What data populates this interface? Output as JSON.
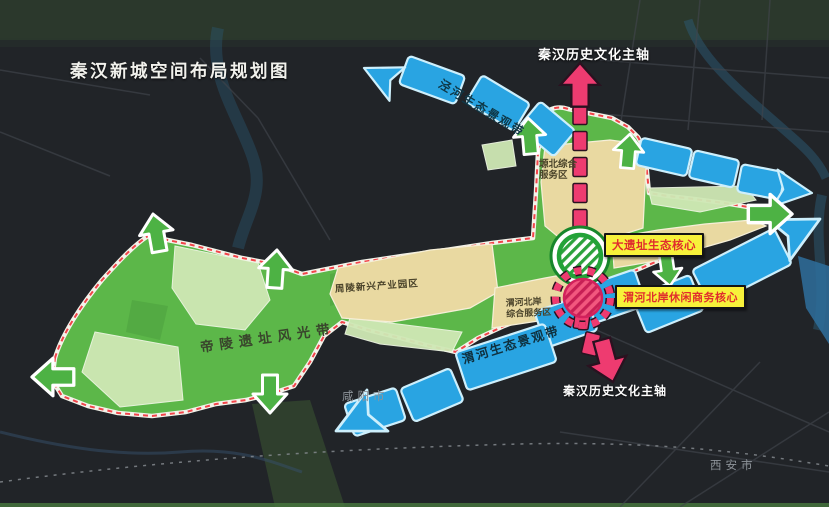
{
  "map": {
    "title": "秦汉新城空间布局规划图",
    "axis": {
      "top_label": "秦汉历史文化主轴",
      "bottom_label": "秦汉历史文化主轴"
    },
    "belts": {
      "jinghe": "泾河生态景观带",
      "weihe": "渭河生态景观带",
      "diling": "帝陵遗址风光带"
    },
    "zones": {
      "yuanbei_line1": "塬北综合",
      "yuanbei_line2": "服务区",
      "zhouling": "周陵新兴产业园区",
      "weihe_service_line1": "渭河北岸",
      "weihe_service_line2": "综合服务区"
    },
    "cores": {
      "heritage": "大遗址生态核心",
      "business": "渭河北岸休闲商务核心"
    },
    "cities": {
      "xianyang": "咸阳市",
      "xian": "西安市"
    },
    "colors": {
      "background": "#212428",
      "green_region": "#5cb749",
      "pale_green_patch": "#cfe8b5",
      "tan_zone": "#e9d9a1",
      "blue_belt": "#29a4e2",
      "pink_axis": "#ee3b70",
      "yellow_label_bg": "#f7f13a",
      "red_label_text": "#e02d2d",
      "boundary_red": "#f2444a",
      "city_text": "#8e949a"
    }
  }
}
